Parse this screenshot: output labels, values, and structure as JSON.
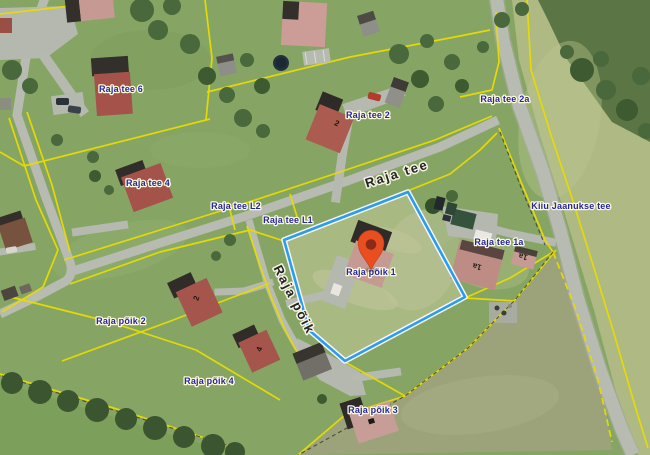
{
  "map": {
    "type": "cadastral-orthophoto-map",
    "selected_parcel": "Raja põik 1",
    "parcel_labels": {
      "raja_tee_6": "Raja tee 6",
      "raja_tee_4": "Raja tee 4",
      "raja_tee_l2": "Raja tee L2",
      "raja_tee_l1": "Raja tee L1",
      "raja_tee_2": "Raja tee 2",
      "raja_tee_2a": "Raja tee 2a",
      "raja_tee_1a": "Raja tee 1a",
      "raja_poik_1": "Raja põik 1",
      "raja_poik_2": "Raja põik 2",
      "raja_poik_3": "Raja põik 3",
      "raja_poik_4": "Raja põik 4",
      "kiiu_jaanukse_tee": "Kiiu Jaanukse tee"
    },
    "road_labels": {
      "raja_tee": "Raja tee",
      "raja_poik": "Raja põik"
    },
    "building_numbers": {
      "raja_tee_2": "2",
      "raja_tee_1a_main": "1a",
      "raja_tee_1a_small": "1a",
      "raja_poik_2": "2",
      "raja_poik_4": "4"
    },
    "colors": {
      "parcel_boundary": "#e8dc00",
      "selected_boundary": "#2d9bf0",
      "marker": "#e84e1f",
      "marker_inner": "#8a2a1a",
      "parcel_label": "#2525a6",
      "road_label": "#232323"
    }
  }
}
